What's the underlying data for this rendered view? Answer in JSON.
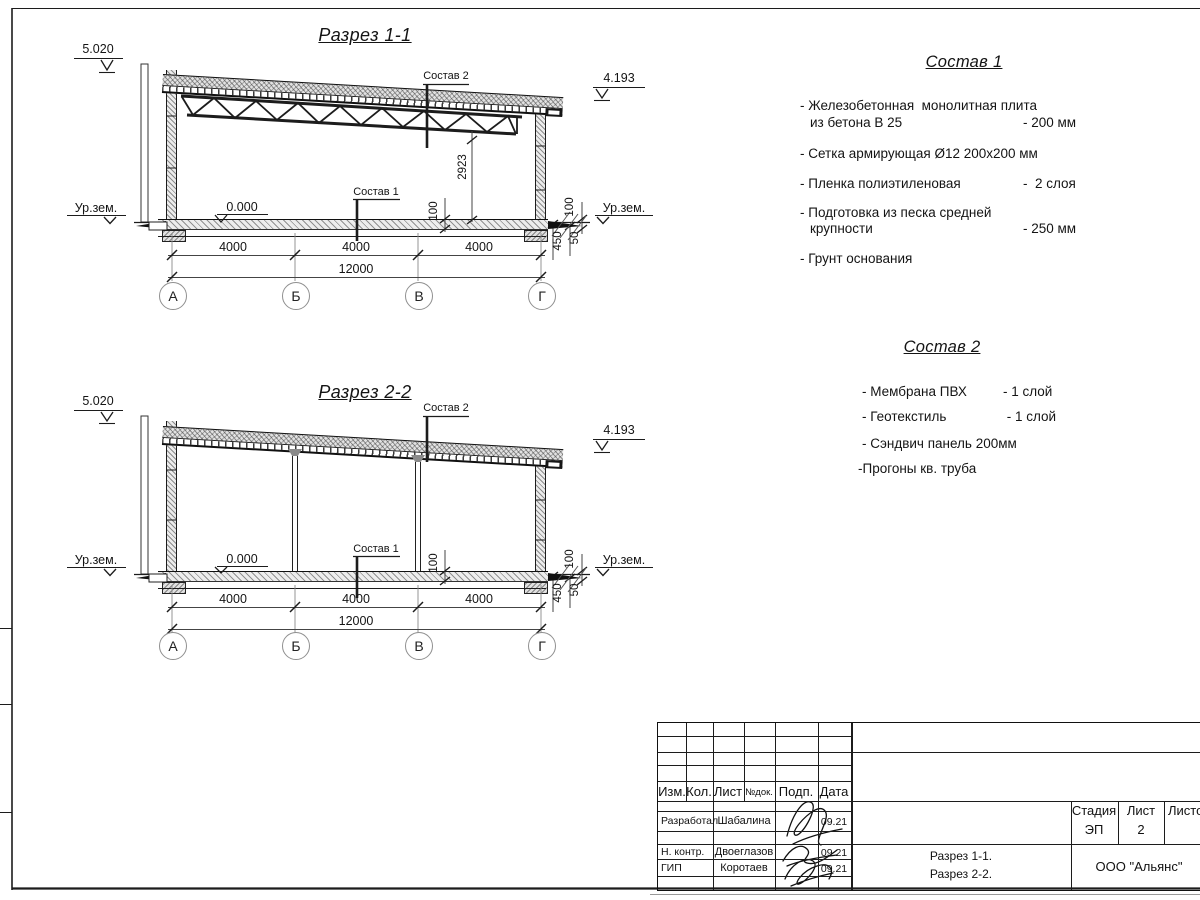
{
  "sections": [
    {
      "title": "Разрез 1-1",
      "elev_top_left": "5.020",
      "elev_top_right": "4.193",
      "elev_zero": "0.000",
      "ground_left": "Ур.зем.",
      "ground_right": "Ур.зем.",
      "leader_roof": "Состав 2",
      "leader_floor": "Состав 1",
      "dim_truss_height": "2923",
      "dim_floor_mid": "100",
      "dim_floor_right": "100",
      "dim_found_depth": "450",
      "dim_found_toe": "50",
      "span_dims": [
        "4000",
        "4000",
        "4000"
      ],
      "total_dim": "12000",
      "axes": [
        "А",
        "Б",
        "В",
        "Г"
      ]
    },
    {
      "title": "Разрез 2-2",
      "elev_top_left": "5.020",
      "elev_top_right": "4.193",
      "elev_zero": "0.000",
      "ground_left": "Ур.зем.",
      "ground_right": "Ур.зем.",
      "leader_roof": "Состав 2",
      "leader_floor": "Состав 1",
      "dim_floor_mid": "100",
      "dim_floor_right": "100",
      "dim_found_depth": "450",
      "dim_found_toe": "50",
      "span_dims": [
        "4000",
        "4000",
        "4000"
      ],
      "total_dim": "12000",
      "axes": [
        "А",
        "Б",
        "В",
        "Г"
      ]
    }
  ],
  "compositions": [
    {
      "title": "Состав 1",
      "items": [
        {
          "label": "- Железобетонная  монолитная плита",
          "label2": "из бетона В 25",
          "value": "- 200 мм"
        },
        {
          "label": "- Сетка армирующая Ø12 200х200 мм",
          "label2": "",
          "value": ""
        },
        {
          "label": "- Пленка полиэтиленовая",
          "label2": "",
          "value": "-  2 слоя"
        },
        {
          "label": "- Подготовка из песка средней",
          "label2": "крупности",
          "value": "- 250 мм"
        },
        {
          "label": "- Грунт основания",
          "label2": "",
          "value": ""
        }
      ]
    },
    {
      "title": "Состав 2",
      "items": [
        {
          "label": "- Мембрана ПВХ",
          "value": "- 1 слой"
        },
        {
          "label": "- Геотекстиль",
          "value": " - 1 слой"
        },
        {
          "label": "- Сэндвич панель 200мм",
          "value": ""
        },
        {
          "label": "-Прогоны кв. труба",
          "value": ""
        }
      ]
    }
  ],
  "titleblock": {
    "headers": [
      "Изм.",
      "Кол.",
      "Лист",
      "№док.",
      "Подп.",
      "Дата"
    ],
    "rows": [
      {
        "role": "Разработал",
        "name": "Шабалина",
        "date": "09.21"
      },
      {
        "role": "Н. контр.",
        "name": "Двоеглазов",
        "date": "09.21"
      },
      {
        "role": "ГИП",
        "name": "Коротаев",
        "date": "09.21"
      }
    ],
    "stage_label": "Стадия",
    "sheet_label": "Лист",
    "sheets_label": "Листов",
    "stage": "ЭП",
    "sheet_no": "2",
    "doc_lines": [
      "Разрез 1-1.",
      "Разрез 2-2."
    ],
    "company": "ООО \"Альянс\""
  }
}
